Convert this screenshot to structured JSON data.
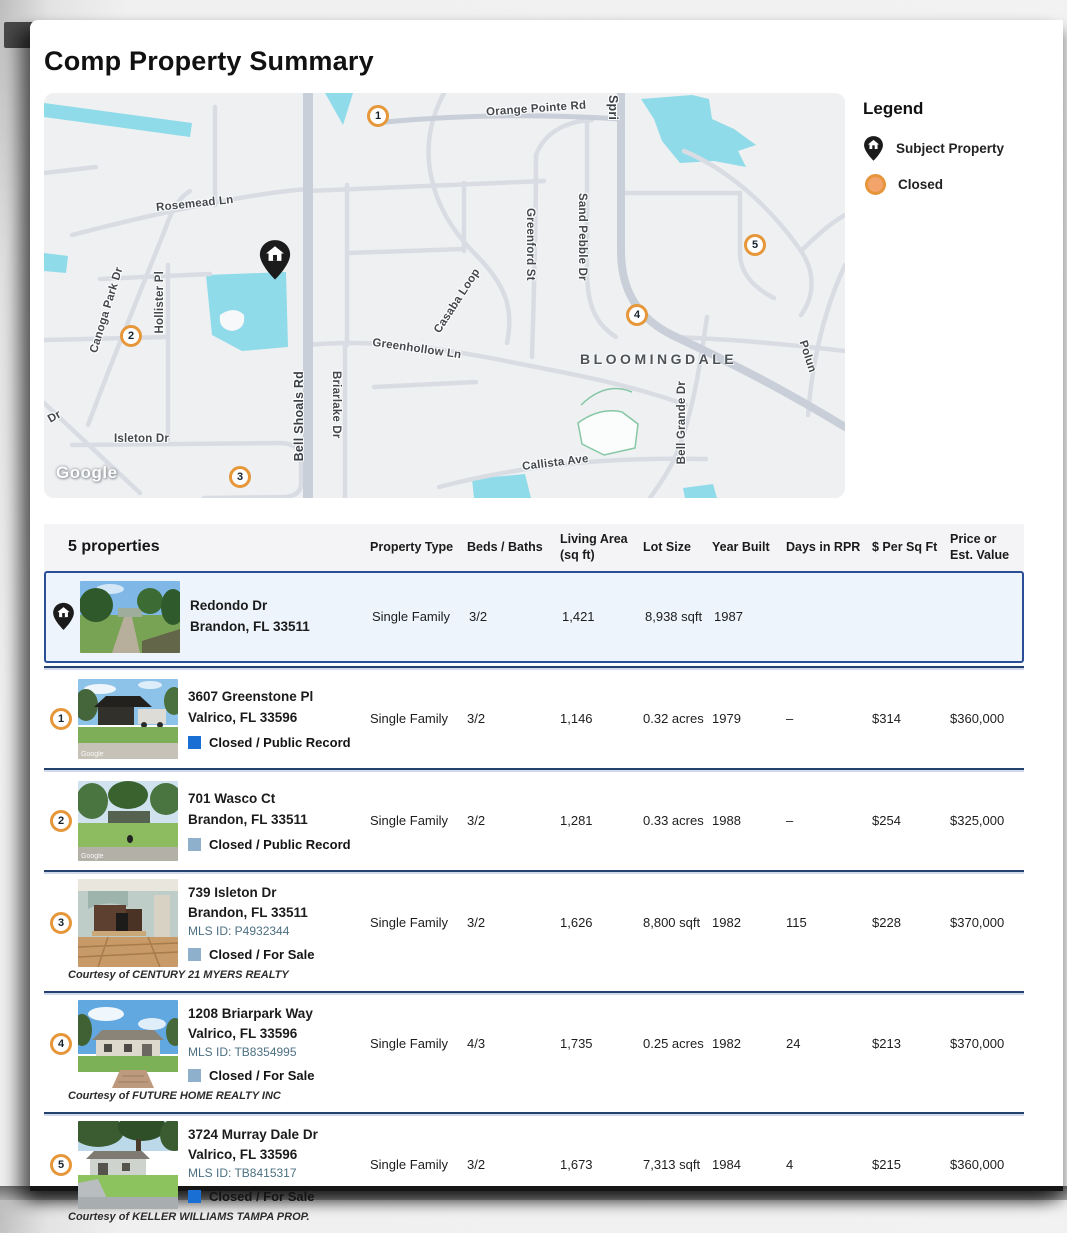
{
  "title": "Comp Property Summary",
  "legend": {
    "title": "Legend",
    "subject_label": "Subject Property",
    "closed_label": "Closed"
  },
  "map": {
    "attribution": "Google",
    "area_label": "BLOOMINGDALE",
    "streets": {
      "orange_pointe": "Orange Pointe Rd",
      "spring": "Spri",
      "rosemead": "Rosemead Ln",
      "casaba": "Casaba Loop",
      "greenford": "Greenford St",
      "sand_pebble": "Sand Pebble Dr",
      "canoga": "Canoga Park Dr",
      "hollister": "Hollister Pl",
      "bell_shoals": "Bell Shoals Rd",
      "briarlake": "Briarlake Dr",
      "greenhollow": "Greenhollow Ln",
      "bell_grande": "Bell Grande Dr",
      "callista": "Callista Ave",
      "isleton": "Isleton Dr",
      "dr": "Dr",
      "polun": "Polun"
    },
    "markers": [
      "1",
      "2",
      "3",
      "4",
      "5"
    ]
  },
  "table": {
    "count_label": "5 properties",
    "columns": [
      "Property Type",
      "Beds / Baths",
      "Living Area (sq ft)",
      "Lot Size",
      "Year Built",
      "Days in RPR",
      "$ Per Sq Ft",
      "Price or Est. Value"
    ],
    "rows": [
      {
        "marker": "subject",
        "address1": "Redondo Dr",
        "address2": "Brandon, FL 33511",
        "mls": "",
        "status": "",
        "courtesy": "",
        "type": "Single Family",
        "beds_baths": "3/2",
        "living_area": "1,421",
        "lot_size": "8,938 sqft",
        "year_built": "1987",
        "days": "",
        "per_sqft": "",
        "price": ""
      },
      {
        "marker": "1",
        "address1": "3607 Greenstone Pl",
        "address2": "Valrico, FL 33596",
        "mls": "",
        "status": "Closed / Public Record",
        "courtesy": "",
        "type": "Single Family",
        "beds_baths": "3/2",
        "living_area": "1,146",
        "lot_size": "0.32 acres",
        "year_built": "1979",
        "days": "–",
        "per_sqft": "$314",
        "price": "$360,000"
      },
      {
        "marker": "2",
        "address1": "701 Wasco Ct",
        "address2": "Brandon, FL 33511",
        "mls": "",
        "status": "Closed / Public Record",
        "courtesy": "",
        "type": "Single Family",
        "beds_baths": "3/2",
        "living_area": "1,281",
        "lot_size": "0.33 acres",
        "year_built": "1988",
        "days": "–",
        "per_sqft": "$254",
        "price": "$325,000"
      },
      {
        "marker": "3",
        "address1": "739 Isleton Dr",
        "address2": "Brandon, FL 33511",
        "mls": "MLS ID: P4932344",
        "status": "Closed / For Sale",
        "courtesy": "Courtesy of CENTURY 21 MYERS REALTY",
        "type": "Single Family",
        "beds_baths": "3/2",
        "living_area": "1,626",
        "lot_size": "8,800 sqft",
        "year_built": "1982",
        "days": "115",
        "per_sqft": "$228",
        "price": "$370,000"
      },
      {
        "marker": "4",
        "address1": "1208 Briarpark Way",
        "address2": "Valrico, FL 33596",
        "mls": "MLS ID: TB8354995",
        "status": "Closed / For Sale",
        "courtesy": "Courtesy of FUTURE HOME REALTY INC",
        "type": "Single Family",
        "beds_baths": "4/3",
        "living_area": "1,735",
        "lot_size": "0.25 acres",
        "year_built": "1982",
        "days": "24",
        "per_sqft": "$213",
        "price": "$370,000"
      },
      {
        "marker": "5",
        "address1": "3724 Murray Dale Dr",
        "address2": "Valrico, FL 33596",
        "mls": "MLS ID: TB8415317",
        "status": "Closed / For Sale",
        "courtesy": "Courtesy of KELLER WILLIAMS TAMPA PROP.",
        "type": "Single Family",
        "beds_baths": "3/2",
        "living_area": "1,673",
        "lot_size": "7,313 sqft",
        "year_built": "1984",
        "days": "4",
        "per_sqft": "$215",
        "price": "$360,000"
      }
    ]
  },
  "colors": {
    "marker_ring_orange": "#E5973A",
    "closed_legend_fill": "#F2A46B",
    "status_square_blue": "#1A6FD4",
    "status_square_muted": "#8FB0CC",
    "subject_row_border": "#2B4F96",
    "subject_row_bg": "#EDF4FC",
    "separator_navy": "#24426F",
    "map_water": "#8FDBE9",
    "map_bg": "#EEF0F2"
  }
}
